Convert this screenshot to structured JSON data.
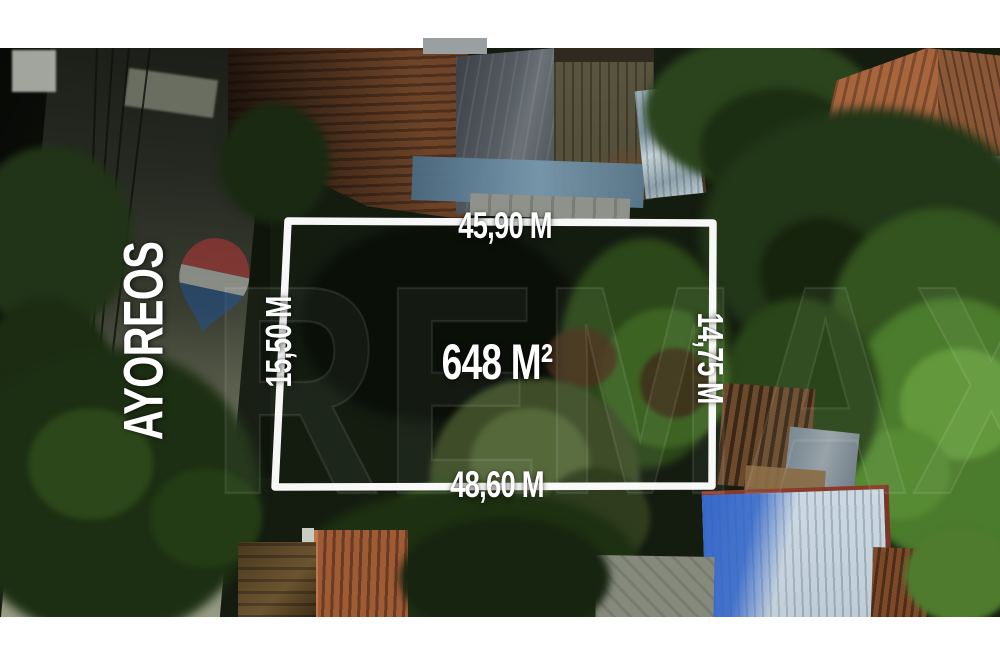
{
  "overlay": {
    "street_name": "AYOREOS",
    "area_label": "648 M²",
    "measurements": {
      "top": "45,90 M",
      "right": "14,75 M",
      "bottom": "48,60 M",
      "left": "15,50 M"
    },
    "watermark": {
      "text": "REMAX",
      "balloon_colors": {
        "red": "#d9393c",
        "white": "#eef1ee",
        "blue": "#1a55a6"
      }
    },
    "boundary_color": "#ffffff"
  }
}
